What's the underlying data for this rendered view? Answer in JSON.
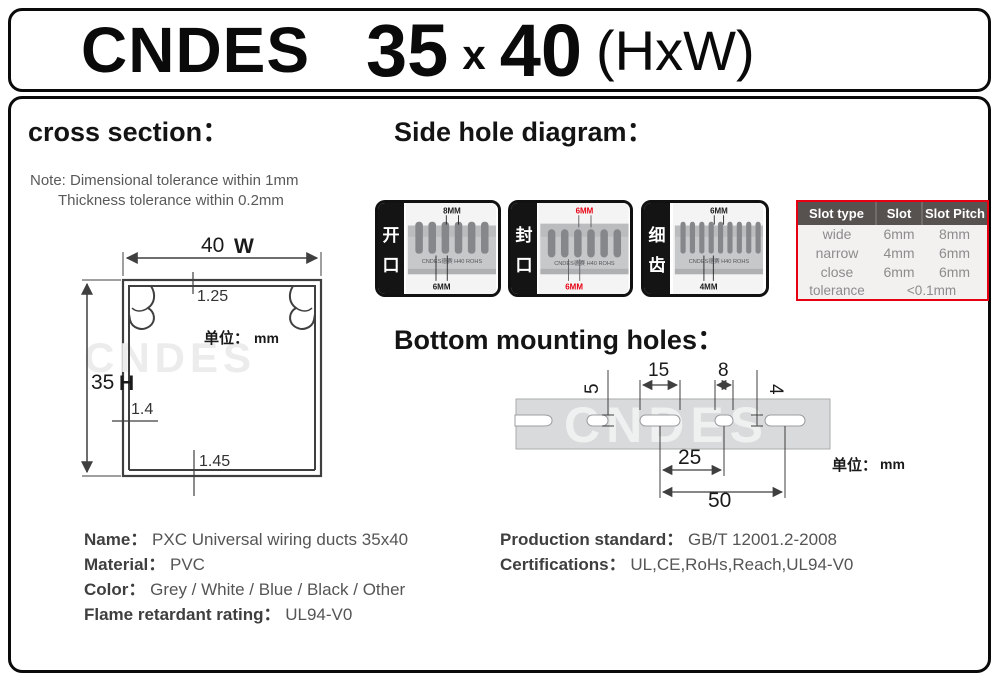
{
  "header": {
    "brand": "CNDES",
    "height": "35",
    "times": "x",
    "width": "40",
    "suffix": "(HxW)"
  },
  "cross_section": {
    "heading": "cross section：",
    "note1": "Note: Dimensional tolerance within 1mm",
    "note2": "Thickness tolerance within 0.2mm",
    "dim_width": "40",
    "dim_width_label": "W",
    "dim_height": "35",
    "dim_height_label": "H",
    "dim_top": "1.25",
    "dim_side": "1.4",
    "dim_bottom": "1.45",
    "unit_label": "单位：",
    "unit_value": "mm",
    "watermark": "CNDES"
  },
  "side_hole": {
    "heading": "Side hole diagram：",
    "photos": [
      {
        "char1": "开",
        "char2": "口",
        "top_dim": "8MM",
        "bottom_dim": "6MM",
        "duct_text": "CNDES德赛 H40 ROHS",
        "label_color": "#1a1a1a"
      },
      {
        "char1": "封",
        "char2": "口",
        "top_dim": "6MM",
        "bottom_dim": "6MM",
        "duct_text": "CNDES德赛 H40 ROHS",
        "label_color": "#e60012"
      },
      {
        "char1": "细",
        "char2": "齿",
        "top_dim": "6MM",
        "bottom_dim": "4MM",
        "duct_text": "CNDES德赛 H40 ROHS",
        "label_color": "#1a1a1a"
      }
    ],
    "table": {
      "headers": [
        "Slot type",
        "Slot",
        "Slot Pitch"
      ],
      "rows": [
        {
          "type": "wide",
          "slot": "6mm",
          "pitch": "8mm"
        },
        {
          "type": "narrow",
          "slot": "4mm",
          "pitch": "6mm"
        },
        {
          "type": "close",
          "slot": "6mm",
          "pitch": "6mm"
        }
      ],
      "tolerance_label": "tolerance",
      "tolerance_value": "<0.1mm"
    }
  },
  "bottom_holes": {
    "heading": "Bottom mounting holes：",
    "d5": "5",
    "d15": "15",
    "d8": "8",
    "d4": "4",
    "d25": "25",
    "d50": "50",
    "unit_label": "单位：",
    "unit_value": "mm",
    "watermark": "CNDES"
  },
  "specs_left": {
    "items": [
      {
        "label": "Name：",
        "value": "PXC Universal wiring ducts 35x40"
      },
      {
        "label": "Material：",
        "value": "PVC"
      },
      {
        "label": "Color：",
        "value": "Grey / White / Blue / Black / Other"
      },
      {
        "label": "Flame retardant rating：",
        "value": "UL94-V0"
      }
    ]
  },
  "specs_right": {
    "items": [
      {
        "label": "Production standard：",
        "value": "GB/T 12001.2-2008"
      },
      {
        "label": "Certifications：",
        "value": "UL,CE,RoHs,Reach,UL94-V0"
      }
    ]
  },
  "colors": {
    "accent_red": "#e60012",
    "table_header_bg": "#575250",
    "duct_gray": "#c6c8ca"
  }
}
